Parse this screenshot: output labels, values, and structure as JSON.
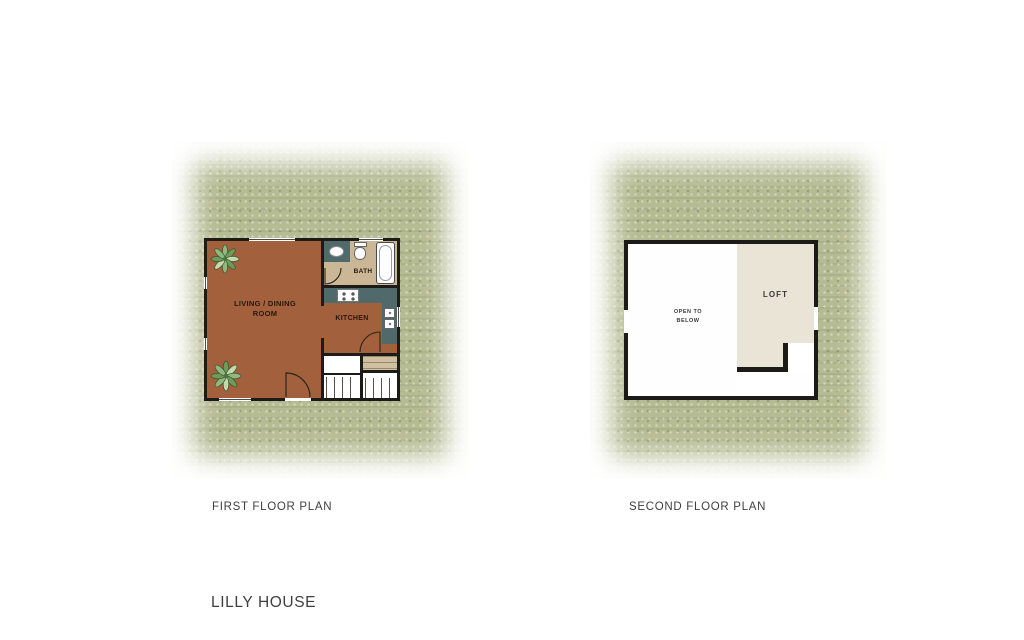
{
  "page": {
    "title": "LILLY HOUSE"
  },
  "colors": {
    "background": "#ffffff",
    "site_green": "#b5bb92",
    "wall_black": "#1d1b17",
    "floor_brown": "#a2603c",
    "bath_tan": "#cbb795",
    "counter_teal": "#50696a",
    "loft_beige": "#eae4d7",
    "stair_tan": "#cfc0a2",
    "label_dark": "#262626",
    "caption_gray": "#3f3f3f"
  },
  "first_floor": {
    "caption": "FIRST FLOOR PLAN",
    "rooms": {
      "living_dining": {
        "label_line1": "LIVING / DINING",
        "label_line2": "ROOM"
      },
      "kitchen": {
        "label": "KITCHEN"
      },
      "bath": {
        "label": "BATH"
      }
    }
  },
  "second_floor": {
    "caption": "SECOND FLOOR PLAN",
    "areas": {
      "open_to_below": {
        "label_line1": "OPEN TO",
        "label_line2": "BELOW"
      },
      "loft": {
        "label": "LOFT"
      }
    }
  }
}
